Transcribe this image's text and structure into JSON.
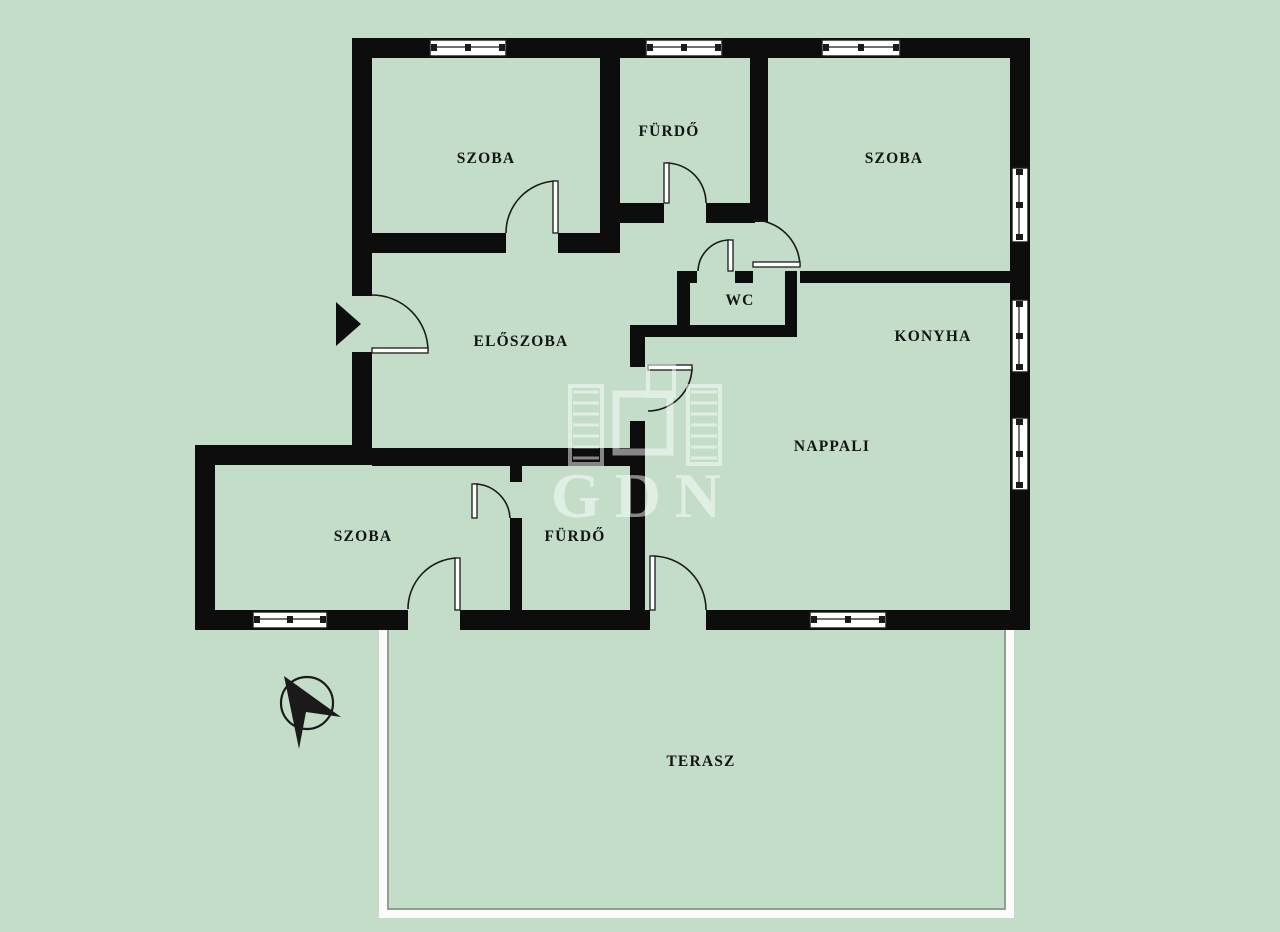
{
  "plan": {
    "title": "apartment-floor-plan",
    "width": 1280,
    "height": 932
  },
  "colors": {
    "background": "#c3ddc9",
    "wall": "#0d0d0d",
    "line": "#1a1a1a",
    "window_fill": "#ffffff",
    "terrace_band": "#fbfbfb",
    "terrace_edge": "#6f7a71",
    "label": "#141414",
    "watermark": "#ffffff"
  },
  "rooms": [
    {
      "id": "szoba-1",
      "label": "SZOBA",
      "x": 486,
      "y": 163
    },
    {
      "id": "furdo-1",
      "label": "FÜRDŐ",
      "x": 669,
      "y": 136
    },
    {
      "id": "szoba-2",
      "label": "SZOBA",
      "x": 894,
      "y": 163
    },
    {
      "id": "wc",
      "label": "WC",
      "x": 740,
      "y": 305
    },
    {
      "id": "eloszoba",
      "label": "ELŐSZOBA",
      "x": 521,
      "y": 346
    },
    {
      "id": "konyha",
      "label": "KONYHA",
      "x": 933,
      "y": 341
    },
    {
      "id": "nappali",
      "label": "NAPPALI",
      "x": 832,
      "y": 451
    },
    {
      "id": "szoba-3",
      "label": "SZOBA",
      "x": 363,
      "y": 541
    },
    {
      "id": "furdo-2",
      "label": "FÜRDŐ",
      "x": 575,
      "y": 541
    },
    {
      "id": "terasz",
      "label": "TERASZ",
      "x": 701,
      "y": 766
    }
  ],
  "walls": [
    [
      355,
      38,
      675,
      20
    ],
    [
      1010,
      38,
      20,
      592
    ],
    [
      195,
      610,
      835,
      20
    ],
    [
      352,
      38,
      20,
      427
    ],
    [
      195,
      445,
      177,
      20
    ],
    [
      195,
      445,
      20,
      185
    ],
    [
      600,
      58,
      20,
      195
    ],
    [
      372,
      233,
      248,
      20
    ],
    [
      620,
      203,
      135,
      20
    ],
    [
      750,
      58,
      18,
      164
    ],
    [
      677,
      271,
      20,
      12
    ],
    [
      735,
      271,
      18,
      12
    ],
    [
      800,
      271,
      210,
      12
    ],
    [
      677,
      271,
      13,
      66
    ],
    [
      785,
      271,
      12,
      66
    ],
    [
      630,
      325,
      167,
      12
    ],
    [
      630,
      325,
      15,
      42
    ],
    [
      630,
      421,
      15,
      192
    ],
    [
      372,
      448,
      273,
      18
    ],
    [
      510,
      448,
      12,
      34
    ],
    [
      510,
      518,
      12,
      95
    ]
  ],
  "door_gaps": [
    [
      352,
      296,
      20,
      56
    ],
    [
      506,
      233,
      52,
      20
    ],
    [
      664,
      203,
      42,
      20
    ],
    [
      697,
      271,
      38,
      12
    ],
    [
      510,
      482,
      12,
      36
    ],
    [
      408,
      610,
      52,
      20
    ],
    [
      650,
      610,
      56,
      20
    ]
  ],
  "doors": [
    {
      "name": "entrance-door",
      "leaf": [
        372,
        348,
        56,
        5
      ],
      "arc": "M428,351 A56,56 0 0 0 372,295"
    },
    {
      "name": "szoba1-door",
      "leaf": [
        553,
        181,
        5,
        52
      ],
      "arc": "M506,233 A52,52 0 0 1 555,181"
    },
    {
      "name": "furdo1-door",
      "leaf": [
        664,
        163,
        5,
        40
      ],
      "arc": "M666,163 A40,40 0 0 1 706,203"
    },
    {
      "name": "wc-door",
      "leaf": [
        728,
        240,
        5,
        31
      ],
      "arc": "M730,240 A32,32 0 0 0 698,271"
    },
    {
      "name": "konyha-door",
      "leaf": [
        753,
        262,
        47,
        5
      ],
      "arc": "M753,220 A47,47 0 0 1 800,266"
    },
    {
      "name": "nappali-door",
      "leaf": [
        648,
        365,
        44,
        5
      ],
      "arc": "M692,367 A44,44 0 0 1 648,411"
    },
    {
      "name": "furdo2-door",
      "leaf": [
        472,
        484,
        5,
        34
      ],
      "arc": "M474,484 A36,36 0 0 1 510,518"
    },
    {
      "name": "szoba3-terasz-door",
      "leaf": [
        455,
        558,
        5,
        52
      ],
      "arc": "M457,558 A51,51 0 0 0 408,609"
    },
    {
      "name": "nappali-terasz-door",
      "leaf": [
        650,
        556,
        5,
        54
      ],
      "arc": "M652,556 A54,54 0 0 1 706,610"
    }
  ],
  "windows": [
    {
      "o": "h",
      "x": 430,
      "y": 38,
      "len": 76
    },
    {
      "o": "h",
      "x": 646,
      "y": 38,
      "len": 76
    },
    {
      "o": "h",
      "x": 822,
      "y": 38,
      "len": 78
    },
    {
      "o": "v",
      "x": 1010,
      "y": 168,
      "len": 74
    },
    {
      "o": "v",
      "x": 1010,
      "y": 300,
      "len": 72
    },
    {
      "o": "v",
      "x": 1010,
      "y": 418,
      "len": 72
    },
    {
      "o": "h",
      "x": 253,
      "y": 610,
      "len": 74
    },
    {
      "o": "h",
      "x": 810,
      "y": 610,
      "len": 76
    }
  ],
  "terrace": {
    "x": 383,
    "y": 616,
    "w": 627,
    "h": 298,
    "band": 8
  },
  "entrance_arrow": {
    "points": "336,302 336,346 361,324"
  },
  "compass": {
    "cx": 307,
    "cy": 703,
    "r": 26,
    "needle_points": "284,676 341,717 306,712 299,749"
  },
  "watermark": {
    "text": "GDN",
    "text_x": 643,
    "text_y": 517,
    "text_size": 64,
    "opacity": 0.5,
    "left_tower": [
      570,
      386,
      32,
      78
    ],
    "right_tower": [
      688,
      386,
      32,
      78
    ],
    "rung_ys": [
      392,
      403,
      414,
      425,
      436,
      447,
      458
    ],
    "big_square": [
      616,
      394,
      54,
      58
    ],
    "small_square": [
      648,
      366,
      26,
      30
    ]
  }
}
